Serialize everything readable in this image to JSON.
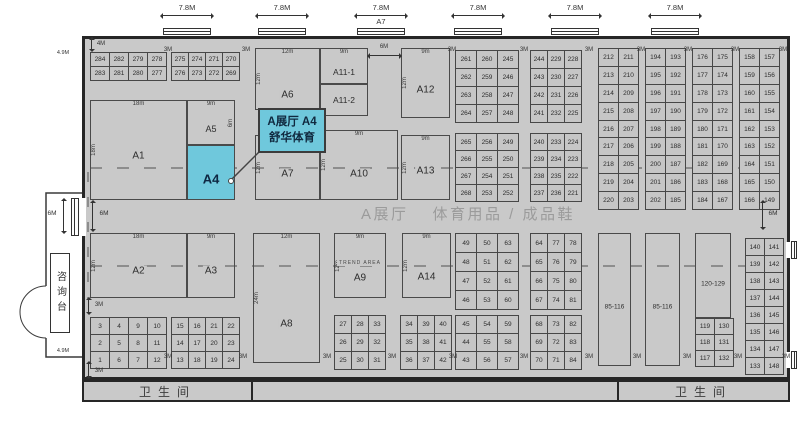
{
  "colors": {
    "hall_bg": "#c9c9c9",
    "cell_bg": "#c6c6c6",
    "wall": "#262626",
    "highlight": "#6fc8dc",
    "title_gray": "#9b9b9b",
    "dash_gray": "#8d8d8d"
  },
  "hall": {
    "title_left": "A展厅",
    "title_right": "体育用品 / 成品鞋"
  },
  "callout": {
    "line1": "A展厅 A4",
    "line2": "舒华体育"
  },
  "restrooms": {
    "left": "卫生间",
    "right": "卫生间"
  },
  "info_desk": "咨询台",
  "doors": [
    {
      "x": 163,
      "label": "7.8M"
    },
    {
      "x": 258,
      "label": "7.8M"
    },
    {
      "x": 357,
      "label": "7.8M",
      "sub": "A7"
    },
    {
      "x": 454,
      "label": "7.8M"
    },
    {
      "x": 551,
      "label": "7.8M"
    },
    {
      "x": 651,
      "label": "7.8M"
    }
  ],
  "zones": [
    {
      "id": "a1",
      "label": "A1",
      "x": 90,
      "y": 100,
      "w": 97,
      "h": 100,
      "top": "18m",
      "left": "18m",
      "ly": 56
    },
    {
      "id": "a5",
      "label": "A5",
      "x": 187,
      "y": 100,
      "w": 48,
      "h": 45,
      "top": "9m",
      "right": "6m",
      "ly": 64,
      "ls": 9
    },
    {
      "id": "a4",
      "label": "A4",
      "x": 187,
      "y": 145,
      "w": 48,
      "h": 55,
      "hl": true,
      "ls": 13,
      "ly": 62
    },
    {
      "id": "a2",
      "label": "A2",
      "x": 90,
      "y": 233,
      "w": 97,
      "h": 65,
      "top": "18m",
      "left": "12m",
      "ly": 58
    },
    {
      "id": "a3",
      "label": "A3",
      "x": 187,
      "y": 233,
      "w": 48,
      "h": 65,
      "top": "9m",
      "ly": 58
    },
    {
      "id": "a6",
      "label": "A6",
      "x": 255,
      "y": 48,
      "w": 65,
      "h": 62,
      "top": "12m",
      "left": "12m",
      "ly": 77
    },
    {
      "id": "a11-1",
      "label": "A11-1",
      "x": 320,
      "y": 48,
      "w": 48,
      "h": 36,
      "top": "9m",
      "ls": 8.5,
      "ly": 68
    },
    {
      "id": "a11-2",
      "label": "A11-2",
      "x": 320,
      "y": 84,
      "w": 48,
      "h": 32,
      "ls": 8.5
    },
    {
      "id": "a12",
      "label": "A12",
      "x": 401,
      "y": 48,
      "w": 49,
      "h": 70,
      "top": "9m",
      "left": "12m",
      "ly": 60
    },
    {
      "id": "a7",
      "label": "A7",
      "x": 255,
      "y": 135,
      "w": 65,
      "h": 65,
      "left": "12m",
      "ly": 60
    },
    {
      "id": "a10",
      "label": "A10",
      "x": 320,
      "y": 130,
      "w": 78,
      "h": 70,
      "top": "9m",
      "left": "12m",
      "ly": 63
    },
    {
      "id": "a13",
      "label": "A13",
      "x": 401,
      "y": 135,
      "w": 49,
      "h": 65,
      "top": "9m",
      "left": "12m",
      "ly": 56
    },
    {
      "id": "a8",
      "label": "A8",
      "x": 253,
      "y": 233,
      "w": 67,
      "h": 130,
      "top": "12m",
      "left": "24m",
      "ly": 70
    },
    {
      "id": "a9",
      "label": "A9",
      "x": 334,
      "y": 233,
      "w": 52,
      "h": 65,
      "top": "9m",
      "left": "12m",
      "sub": "TREND AREA",
      "ly": 70
    },
    {
      "id": "a14",
      "label": "A14",
      "x": 402,
      "y": 233,
      "w": 49,
      "h": 65,
      "top": "9m",
      "left": "12m",
      "ly": 68
    },
    {
      "id": "b85-116-a",
      "label": "85-116",
      "x": 598,
      "y": 233,
      "w": 33,
      "h": 133,
      "ls": 6.5,
      "ly": 56
    },
    {
      "id": "b85-116-b",
      "label": "85-116",
      "x": 645,
      "y": 233,
      "w": 35,
      "h": 133,
      "ls": 6.5,
      "ly": 56
    },
    {
      "id": "b120-129",
      "label": "120-129",
      "x": 695,
      "y": 233,
      "w": 36,
      "h": 85,
      "ls": 6.5,
      "ly": 60
    }
  ],
  "grids": [
    {
      "x": 90,
      "y": 52,
      "cw": 18,
      "ch": 13,
      "rows": [
        [
          "284",
          "282",
          "279",
          "278"
        ],
        [
          "283",
          "281",
          "280",
          "277"
        ]
      ]
    },
    {
      "x": 171,
      "y": 52,
      "cw": 16,
      "ch": 13,
      "rows": [
        [
          "275",
          "274",
          "271",
          "270"
        ],
        [
          "276",
          "273",
          "272",
          "269"
        ]
      ]
    },
    {
      "x": 90,
      "y": 317,
      "cw": 18,
      "ch": 16,
      "rows": [
        [
          "3",
          "4",
          "9",
          "10"
        ],
        [
          "2",
          "5",
          "8",
          "11"
        ],
        [
          "1",
          "6",
          "7",
          "12"
        ]
      ]
    },
    {
      "x": 171,
      "y": 317,
      "cw": 16,
      "ch": 16,
      "rows": [
        [
          "15",
          "16",
          "21",
          "22"
        ],
        [
          "14",
          "17",
          "20",
          "23"
        ],
        [
          "13",
          "18",
          "19",
          "24"
        ]
      ]
    },
    {
      "x": 334,
      "y": 315,
      "cw": 16,
      "ch": 17,
      "rows": [
        [
          "27",
          "28",
          "33"
        ],
        [
          "26",
          "29",
          "32"
        ],
        [
          "25",
          "30",
          "31"
        ]
      ]
    },
    {
      "x": 400,
      "y": 315,
      "cw": 16,
      "ch": 17,
      "rows": [
        [
          "34",
          "39",
          "40"
        ],
        [
          "35",
          "38",
          "41"
        ],
        [
          "36",
          "37",
          "42"
        ]
      ]
    },
    {
      "x": 455,
      "y": 50,
      "cw": 20,
      "ch": 17,
      "rows": [
        [
          "261",
          "260",
          "245"
        ],
        [
          "262",
          "259",
          "246"
        ],
        [
          "263",
          "258",
          "247"
        ],
        [
          "264",
          "257",
          "248"
        ]
      ]
    },
    {
      "x": 455,
      "y": 133,
      "cw": 20,
      "ch": 16,
      "rows": [
        [
          "265",
          "256",
          "249"
        ],
        [
          "266",
          "255",
          "250"
        ],
        [
          "267",
          "254",
          "251"
        ],
        [
          "268",
          "253",
          "252"
        ]
      ]
    },
    {
      "x": 530,
      "y": 50,
      "cw": 16,
      "ch": 17,
      "rows": [
        [
          "244",
          "229",
          "228"
        ],
        [
          "243",
          "230",
          "227"
        ],
        [
          "242",
          "231",
          "226"
        ],
        [
          "241",
          "232",
          "225"
        ]
      ]
    },
    {
      "x": 530,
      "y": 133,
      "cw": 16,
      "ch": 16,
      "rows": [
        [
          "240",
          "233",
          "224"
        ],
        [
          "239",
          "234",
          "223"
        ],
        [
          "238",
          "235",
          "222"
        ],
        [
          "237",
          "236",
          "221"
        ]
      ]
    },
    {
      "x": 455,
      "y": 233,
      "cw": 20,
      "ch": 18,
      "rows": [
        [
          "49",
          "50",
          "63"
        ],
        [
          "48",
          "51",
          "62"
        ],
        [
          "47",
          "52",
          "61"
        ],
        [
          "46",
          "53",
          "60"
        ]
      ]
    },
    {
      "x": 455,
      "y": 315,
      "cw": 20,
      "ch": 17,
      "rows": [
        [
          "45",
          "54",
          "59"
        ],
        [
          "44",
          "55",
          "58"
        ],
        [
          "43",
          "56",
          "57"
        ]
      ]
    },
    {
      "x": 530,
      "y": 233,
      "cw": 16,
      "ch": 18,
      "rows": [
        [
          "64",
          "77",
          "78"
        ],
        [
          "65",
          "76",
          "79"
        ],
        [
          "66",
          "75",
          "80"
        ],
        [
          "67",
          "74",
          "81"
        ]
      ]
    },
    {
      "x": 530,
      "y": 315,
      "cw": 16,
      "ch": 17,
      "rows": [
        [
          "68",
          "73",
          "82"
        ],
        [
          "69",
          "72",
          "83"
        ],
        [
          "70",
          "71",
          "84"
        ]
      ]
    },
    {
      "x": 598,
      "y": 48,
      "cw": 19,
      "ch": 16.9,
      "rows": [
        [
          "212",
          "211"
        ],
        [
          "213",
          "210"
        ],
        [
          "214",
          "209"
        ],
        [
          "215",
          "208"
        ],
        [
          "216",
          "207"
        ],
        [
          "217",
          "206"
        ],
        [
          "218",
          "205"
        ],
        [
          "219",
          "204"
        ],
        [
          "220",
          "203"
        ]
      ]
    },
    {
      "x": 645,
      "y": 48,
      "cw": 19,
      "ch": 16.9,
      "rows": [
        [
          "194",
          "193"
        ],
        [
          "195",
          "192"
        ],
        [
          "196",
          "191"
        ],
        [
          "197",
          "190"
        ],
        [
          "198",
          "189"
        ],
        [
          "199",
          "188"
        ],
        [
          "200",
          "187"
        ],
        [
          "201",
          "186"
        ],
        [
          "202",
          "185"
        ]
      ]
    },
    {
      "x": 692,
      "y": 48,
      "cw": 19,
      "ch": 16.9,
      "rows": [
        [
          "176",
          "175"
        ],
        [
          "177",
          "174"
        ],
        [
          "178",
          "173"
        ],
        [
          "179",
          "172"
        ],
        [
          "180",
          "171"
        ],
        [
          "181",
          "170"
        ],
        [
          "182",
          "169"
        ],
        [
          "183",
          "168"
        ],
        [
          "184",
          "167"
        ]
      ]
    },
    {
      "x": 739,
      "y": 48,
      "cw": 19,
      "ch": 16.9,
      "rows": [
        [
          "158",
          "157"
        ],
        [
          "159",
          "156"
        ],
        [
          "160",
          "155"
        ],
        [
          "161",
          "154"
        ],
        [
          "162",
          "153"
        ],
        [
          "163",
          "152"
        ],
        [
          "164",
          "151"
        ],
        [
          "165",
          "150"
        ],
        [
          "166",
          "149"
        ]
      ]
    },
    {
      "x": 695,
      "y": 318,
      "cw": 18,
      "ch": 15,
      "rows": [
        [
          "119",
          "130"
        ],
        [
          "118",
          "131"
        ],
        [
          "117",
          "132"
        ]
      ]
    },
    {
      "x": 745,
      "y": 238,
      "cw": 18,
      "ch": 16,
      "rows": [
        [
          "140",
          "141"
        ],
        [
          "139",
          "142"
        ],
        [
          "138",
          "143"
        ],
        [
          "137",
          "144"
        ],
        [
          "136",
          "145"
        ],
        [
          "135",
          "146"
        ],
        [
          "134",
          "147"
        ],
        [
          "133",
          "148"
        ]
      ]
    }
  ],
  "dims": [
    {
      "t": "4M",
      "x": 101,
      "y": 41,
      "s": 6
    },
    {
      "t": "4.9M",
      "x": 63,
      "y": 50,
      "s": 5.5
    },
    {
      "t": "4.9M",
      "x": 63,
      "y": 348,
      "s": 5.5
    },
    {
      "t": "3M",
      "x": 168,
      "y": 47,
      "s": 6
    },
    {
      "t": "3M",
      "x": 246,
      "y": 47,
      "s": 6
    },
    {
      "t": "3M",
      "x": 452,
      "y": 47,
      "s": 6
    },
    {
      "t": "3M",
      "x": 524,
      "y": 47,
      "s": 6
    },
    {
      "t": "3M",
      "x": 589,
      "y": 47,
      "s": 6
    },
    {
      "t": "3M",
      "x": 641,
      "y": 47,
      "s": 6
    },
    {
      "t": "3M",
      "x": 688,
      "y": 47,
      "s": 6
    },
    {
      "t": "3M",
      "x": 735,
      "y": 47,
      "s": 6
    },
    {
      "t": "3M",
      "x": 783,
      "y": 47,
      "s": 6
    },
    {
      "t": "6M",
      "x": 384,
      "y": 44,
      "s": 6
    },
    {
      "t": "6M",
      "x": 104,
      "y": 210,
      "s": 6.5
    },
    {
      "t": "6M",
      "x": 52,
      "y": 210,
      "s": 6.5
    },
    {
      "t": "6M",
      "x": 773,
      "y": 210,
      "s": 6.5
    },
    {
      "t": "3M",
      "x": 99,
      "y": 302,
      "s": 6
    },
    {
      "t": "3M",
      "x": 99,
      "y": 368,
      "s": 6
    },
    {
      "t": "3M",
      "x": 168,
      "y": 354,
      "s": 6
    },
    {
      "t": "3M",
      "x": 243,
      "y": 354,
      "s": 6
    },
    {
      "t": "3M",
      "x": 327,
      "y": 354,
      "s": 6
    },
    {
      "t": "3M",
      "x": 392,
      "y": 354,
      "s": 6
    },
    {
      "t": "3M",
      "x": 453,
      "y": 354,
      "s": 6
    },
    {
      "t": "3M",
      "x": 524,
      "y": 354,
      "s": 6
    },
    {
      "t": "3M",
      "x": 589,
      "y": 354,
      "s": 6
    },
    {
      "t": "3M",
      "x": 637,
      "y": 354,
      "s": 6
    },
    {
      "t": "3M",
      "x": 687,
      "y": 354,
      "s": 6
    },
    {
      "t": "3M",
      "x": 738,
      "y": 354,
      "s": 6
    },
    {
      "t": "3M",
      "x": 786,
      "y": 354,
      "s": 6
    }
  ],
  "arrows": [
    {
      "o": "v",
      "x": 91,
      "y": 38,
      "len": 13
    },
    {
      "o": "v",
      "x": 92,
      "y": 201,
      "len": 30
    },
    {
      "o": "v",
      "x": 63,
      "y": 199,
      "len": 34
    },
    {
      "o": "v",
      "x": 762,
      "y": 201,
      "len": 28
    },
    {
      "o": "v",
      "x": 88,
      "y": 298,
      "len": 16
    },
    {
      "o": "v",
      "x": 88,
      "y": 362,
      "len": 16
    },
    {
      "o": "h",
      "x": 368,
      "y": 55,
      "len": 33
    }
  ],
  "dashes": [
    {
      "o": "h",
      "x": 90,
      "y": 167,
      "len": 694
    },
    {
      "o": "h",
      "x": 90,
      "y": 265,
      "len": 694
    },
    {
      "o": "v",
      "x": 87,
      "y": 172,
      "len": 128
    }
  ]
}
